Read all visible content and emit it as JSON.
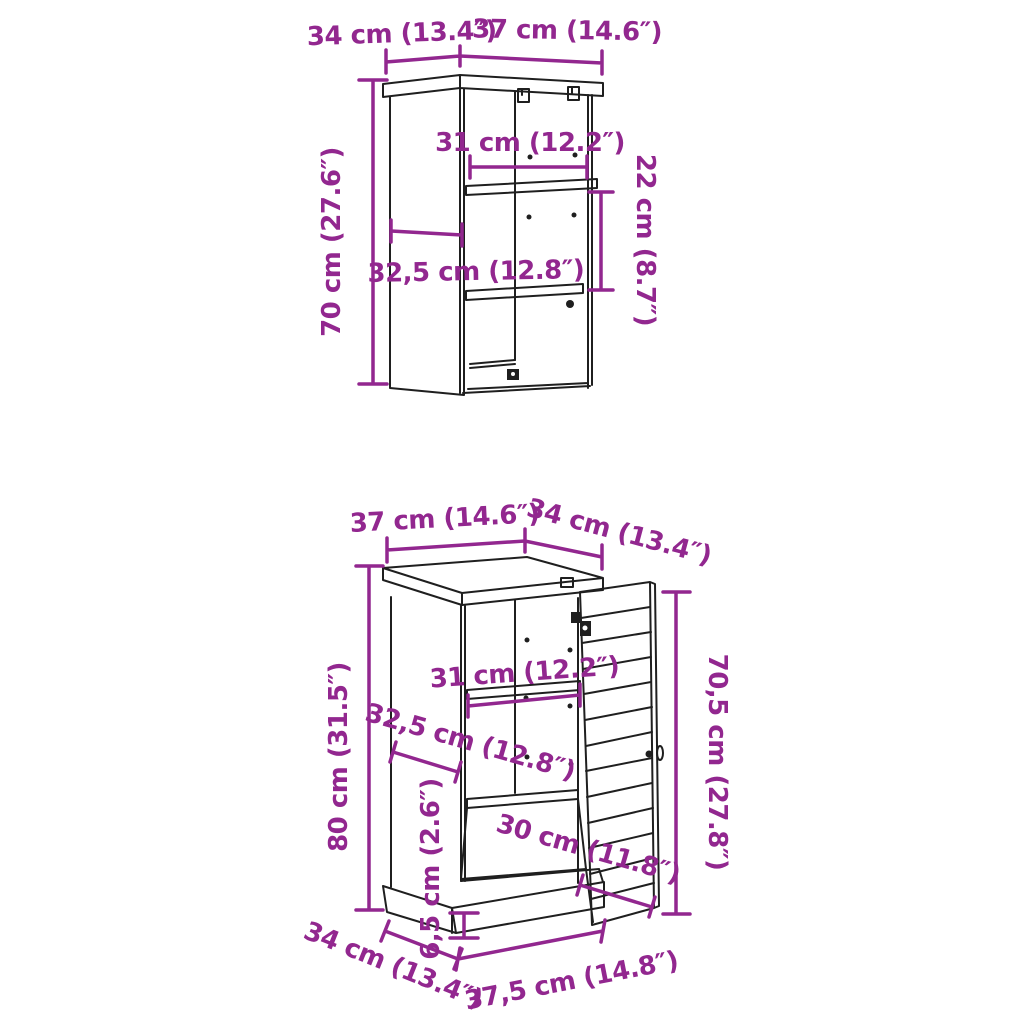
{
  "background": "#ffffff",
  "colors": {
    "dimension": "#92278F",
    "line_art": "#1f1f1f"
  },
  "wall_cabinet": {
    "dims": {
      "top_depth": "34 cm (13.4″)",
      "top_width": "37 cm (14.6″)",
      "height": "70 cm (27.6″)",
      "inner_width": "31 cm (12.2″)",
      "compartment_height": "22 cm (8.7″)",
      "inner_depth": "32,5 cm (12.8″)"
    }
  },
  "floor_cabinet": {
    "dims": {
      "top_width": "37 cm (14.6″)",
      "top_depth": "34 cm (13.4″)",
      "height": "80 cm (31.5″)",
      "inner_width": "31 cm (12.2″)",
      "inner_depth": "32,5 cm (12.8″)",
      "door_height": "70,5 cm (27.8″)",
      "door_width": "30 cm (11.8″)",
      "plinth_height": "6,5 cm (2.6″)",
      "base_depth": "34 cm (13.4″)",
      "base_width": "37,5 cm (14.8″)"
    }
  }
}
